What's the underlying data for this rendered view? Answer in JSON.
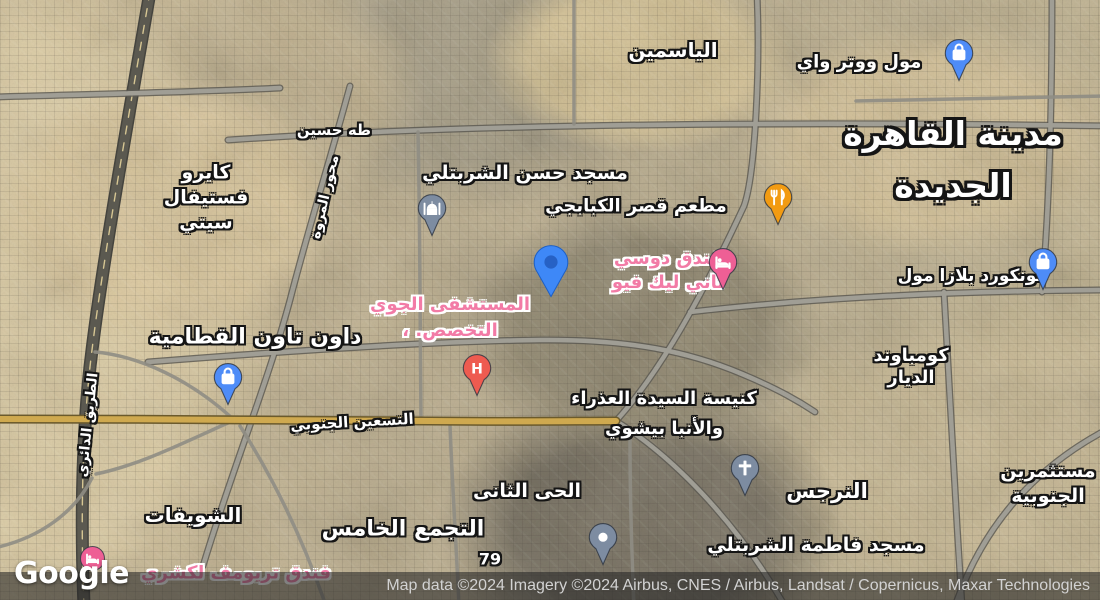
{
  "attribution": {
    "logo_text": "Google",
    "text": "Map data ©2024 Imagery ©2024 Airbus, CNES / Airbus, Landsat / Copernicus, Maxar Technologies"
  },
  "colors": {
    "poi_blue": "#4e8cf7",
    "poi_slate": "#7d8ca1",
    "poi_orange": "#f29b12",
    "poi_pink": "#ee5f95",
    "poi_red": "#ee5b50",
    "label_pink": "#f27ba6",
    "road_yellow": "#cfa94f",
    "location_blue": "#3e88f7"
  },
  "labels": [
    {
      "id": "yasmeen",
      "kind": "area",
      "text": "الياسمين",
      "x": 673,
      "y": 50,
      "size": 20
    },
    {
      "id": "cairo-festival-city",
      "kind": "area",
      "lines": [
        "كايرو",
        "فستيفال",
        "سيتي"
      ],
      "x": 206,
      "y": 198,
      "size": 19,
      "lh": 25
    },
    {
      "id": "downtown-katameya",
      "kind": "area",
      "text": "داون تاون القطامية",
      "x": 255,
      "y": 337,
      "size": 22
    },
    {
      "id": "shouifat",
      "kind": "area",
      "text": "الشويفات",
      "x": 193,
      "y": 515,
      "size": 20
    },
    {
      "id": "tagamoa-khames",
      "kind": "area",
      "text": "التجمع الخامس",
      "x": 403,
      "y": 529,
      "size": 22
    },
    {
      "id": "hay-thani",
      "kind": "area",
      "text": "الحى الثانى",
      "x": 527,
      "y": 491,
      "size": 19
    },
    {
      "id": "narges",
      "kind": "area",
      "text": "النرجس",
      "x": 827,
      "y": 491,
      "size": 21
    },
    {
      "id": "compound-diyar",
      "kind": "area",
      "lines": [
        "كومباوند",
        "الديار"
      ],
      "x": 911,
      "y": 367,
      "size": 18,
      "lh": 22
    },
    {
      "id": "investors-south",
      "kind": "area",
      "lines": [
        "مستثمرين",
        "الجنوبية"
      ],
      "x": 1048,
      "y": 484,
      "size": 19,
      "lh": 25
    },
    {
      "id": "new-cairo-city",
      "kind": "city",
      "lines": [
        "مدينة القاهرة",
        "الجديدة"
      ],
      "x": 953,
      "y": 160,
      "size": 33,
      "lh": 52
    },
    {
      "id": "waterway-mall",
      "kind": "poi",
      "text": "مول ووتر واي",
      "x": 859,
      "y": 62,
      "size": 18
    },
    {
      "id": "hassan-sharbatly-mosque",
      "kind": "poi",
      "text": "مسجد حسن الشربتلي",
      "x": 525,
      "y": 173,
      "size": 19
    },
    {
      "id": "kababgi-restaurant",
      "kind": "poi",
      "text": "مطعم قصر الكبابجي",
      "x": 636,
      "y": 206,
      "size": 18
    },
    {
      "id": "concord-plaza-mall",
      "kind": "poi",
      "text": "كونكورد بلازا مول",
      "x": 972,
      "y": 276,
      "size": 17
    },
    {
      "id": "virgin-mary-church",
      "kind": "poi",
      "lines": [
        "كنيسة السيدة العذراء",
        "والأنبا بيشوي"
      ],
      "x": 664,
      "y": 414,
      "size": 18,
      "lh": 30
    },
    {
      "id": "fatma-sharbatly-mosque",
      "kind": "poi",
      "text": "مسجد فاطمة الشربتلي",
      "x": 816,
      "y": 545,
      "size": 19
    },
    {
      "id": "dusit-thani-hotel",
      "kind": "pink",
      "lines": [
        "فندق دوسي",
        "تاني ليك فيو"
      ],
      "x": 668,
      "y": 271,
      "size": 18,
      "lh": 24
    },
    {
      "id": "air-specialized-hospital",
      "kind": "pink",
      "lines": [
        "المستشفى الجوي",
        "التخصص. ،"
      ],
      "x": 450,
      "y": 318,
      "size": 18,
      "lh": 26
    },
    {
      "id": "triumph-luxury-hotel",
      "kind": "pink",
      "text": "فندق تريومف لكشري",
      "x": 236,
      "y": 573,
      "size": 18
    },
    {
      "id": "taha-hussein-road",
      "kind": "road",
      "text": "طه حسين",
      "x": 334,
      "y": 130,
      "size": 15
    },
    {
      "id": "mehwar-marwa-road",
      "kind": "road",
      "text": "محور المروة",
      "x": 325,
      "y": 197,
      "size": 14,
      "rotate": -77
    },
    {
      "id": "ring-road",
      "kind": "road",
      "text": "الطريق الدائري",
      "x": 88,
      "y": 425,
      "size": 14,
      "rotate": -84
    },
    {
      "id": "teseen-south-road",
      "kind": "road",
      "text": "التسعين الجنوبي",
      "x": 352,
      "y": 422,
      "size": 15,
      "rotate": -3
    },
    {
      "id": "route-79",
      "kind": "road",
      "text": "79",
      "x": 490,
      "y": 559,
      "size": 16,
      "latin": true
    }
  ],
  "markers": [
    {
      "id": "waterway-mall-pin",
      "icon": "shopping-bag-icon",
      "shape": "pin",
      "color": "#4e8cf7",
      "x": 959,
      "y": 53
    },
    {
      "id": "downtown-katameya-pin",
      "icon": "shopping-bag-icon",
      "shape": "pin",
      "color": "#4e8cf7",
      "x": 228,
      "y": 377
    },
    {
      "id": "concord-plaza-pin",
      "icon": "shopping-bag-icon",
      "shape": "pin",
      "color": "#4e8cf7",
      "x": 1043,
      "y": 262
    },
    {
      "id": "hassan-sharbatly-mosque-pin",
      "icon": "mosque-icon",
      "shape": "pin",
      "color": "#7d8ca1",
      "x": 432,
      "y": 208
    },
    {
      "id": "virgin-mary-church-pin",
      "icon": "cross-icon",
      "shape": "pin",
      "color": "#7d8ca1",
      "x": 745,
      "y": 468
    },
    {
      "id": "fatma-sharbatly-mosque-pin",
      "icon": "dot-icon",
      "shape": "pin",
      "color": "#7d8ca1",
      "x": 603,
      "y": 537
    },
    {
      "id": "kababgi-restaurant-pin",
      "icon": "restaurant-icon",
      "shape": "pin",
      "color": "#f29b12",
      "x": 778,
      "y": 197
    },
    {
      "id": "dusit-thani-hotel-pin",
      "icon": "bed-icon",
      "shape": "pin",
      "color": "#ee5f95",
      "x": 723,
      "y": 262
    },
    {
      "id": "air-hospital-pin",
      "icon": "hospital-h-icon",
      "shape": "pin",
      "color": "#ee5b50",
      "x": 477,
      "y": 368
    },
    {
      "id": "triumph-hotel-circle",
      "icon": "bed-icon",
      "shape": "circle",
      "color": "#ee5f95",
      "x": 92,
      "y": 558
    },
    {
      "id": "dropped-location-pin",
      "icon": "location-pin-icon",
      "shape": "location",
      "color": "#3e88f7",
      "x": 551,
      "y": 262
    }
  ]
}
